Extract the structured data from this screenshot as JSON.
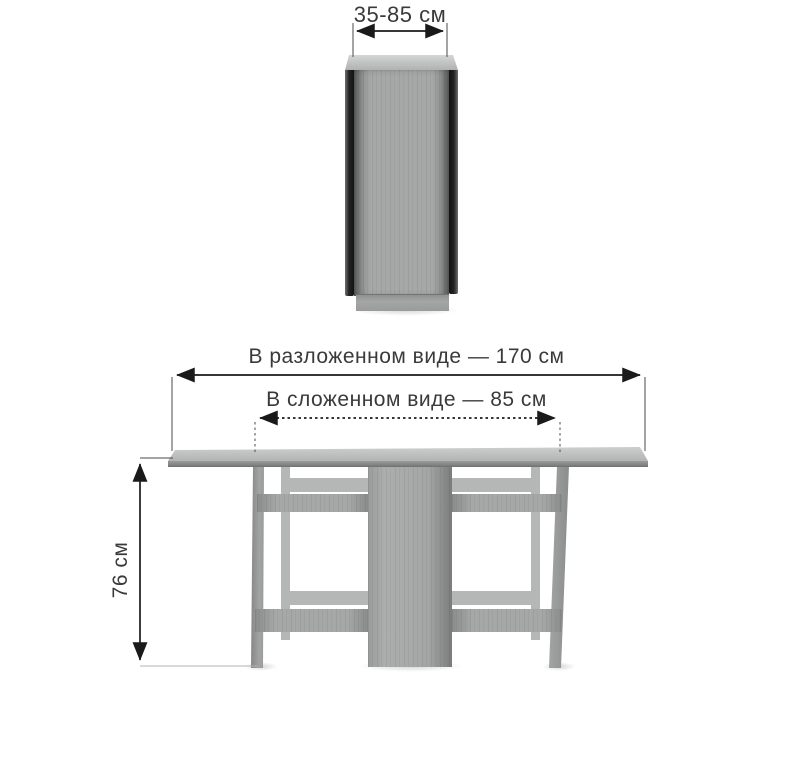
{
  "folded_view": {
    "width_dimension_label": "35-85 см"
  },
  "unfolded_view": {
    "length_unfolded_label": "В разложенном виде — 170 см",
    "length_folded_label": "В сложенном виде — 85 см",
    "height_dimension_label": "76 см"
  },
  "colors": {
    "background": "#ffffff",
    "text": "#3a3a3a",
    "dimension_line": "#1a1a1a",
    "extension_line": "#4a4a4a",
    "floor_line": "#b3b3b3",
    "wood_base": "#a6a8a8",
    "wood_light": "#c6c8c8",
    "wood_back": "#b5b7b7",
    "wood_dark": "#8a8c8c",
    "edge_dark": "#1e1e1e"
  }
}
